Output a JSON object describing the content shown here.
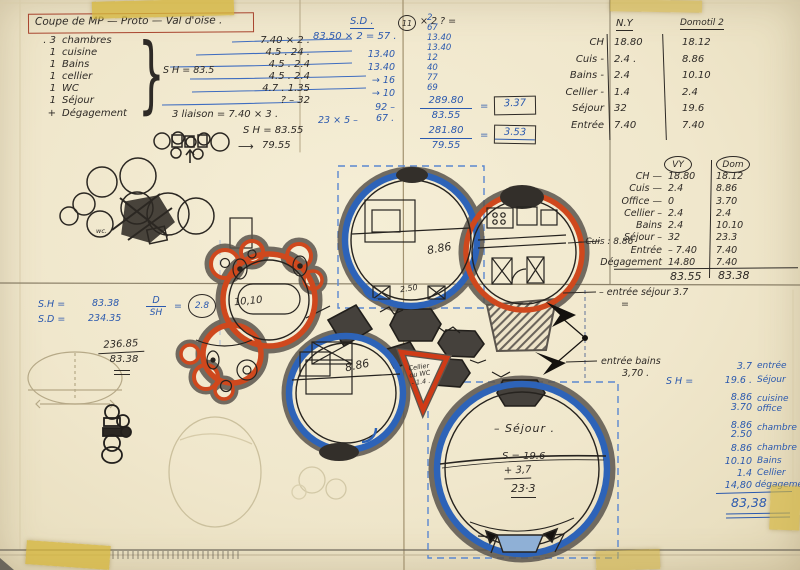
{
  "colors": {
    "paper": "#f0e8cf",
    "ink": "#2e2a26",
    "blue": "#2b59ae",
    "red": "#c63d17",
    "tape": "#d5b63e"
  },
  "icons": {
    "arrow_right": "⟶"
  },
  "title": "Coupe de MP — Proto — Val d'oise .",
  "program": {
    "items": [
      {
        "qty": ". 3",
        "label": "chambres"
      },
      {
        "qty": "1",
        "label": "cuisine"
      },
      {
        "qty": "1",
        "label": "Bains"
      },
      {
        "qty": "1",
        "label": "cellier"
      },
      {
        "qty": "1",
        "label": "WC"
      },
      {
        "qty": "1",
        "label": "Séjour"
      },
      {
        "qty": "+",
        "label": "Dégagement"
      }
    ],
    "sh_note": "S H = 83.5",
    "values": [
      "7.40 × 2 .",
      "4.5 . 24 .",
      "4.5 . 2.4",
      "4.5 . 2.4",
      "4.7 . 1.35",
      "? –   32",
      "3 liaison  =  7.40 × 3 ."
    ],
    "circle_value": "11",
    "circle_suffix": "× 2 ? =",
    "sh_total": "S H = 83.55",
    "arrow_total": "79.55",
    "wc_note": "wc."
  },
  "calc_sd": {
    "head": "S.D .",
    "line": "83.50 × 2  =  57 .",
    "vals": [
      "13.40",
      "13.40",
      "→ 16",
      "→ 10",
      "92 –"
    ],
    "last_left": "23 × 5 –",
    "last_right": "67 ."
  },
  "calc_right": {
    "col": [
      "2",
      "67",
      "13.40",
      "13.40",
      "12",
      "40",
      "77",
      "69"
    ],
    "f1_num": "289.80",
    "f1_den": "83.55",
    "eq": "=",
    "f1_res": "3.37",
    "f2_num": "281.80",
    "f2_den": "79.55",
    "f2_res": "3.53"
  },
  "table1": {
    "h1": "N.Y",
    "h2": "Domotil 2",
    "rows": [
      [
        "CH",
        "18.80",
        "18.12"
      ],
      [
        "Cuis -",
        "2.4 .",
        "8.86"
      ],
      [
        "Bains -",
        "2.4",
        "10.10"
      ],
      [
        "Cellier -",
        "1.4",
        "2.4"
      ],
      [
        "Séjour",
        "32",
        "19.6"
      ],
      [
        "Entrée",
        "7.40",
        "7.40"
      ]
    ]
  },
  "table2": {
    "h1": "VY",
    "h2": "Dom",
    "rows": [
      [
        "CH  —",
        "18.80",
        "18.12"
      ],
      [
        "Cuis  —",
        "2.4",
        "8.86"
      ],
      [
        "Office  —",
        "0",
        "3.70"
      ],
      [
        "Cellier  –",
        "2.4",
        "2.4"
      ],
      [
        "Bains",
        "2.4",
        "10.10"
      ],
      [
        "Séjour  –",
        "32",
        "23.3"
      ],
      [
        "Entrée",
        "– 7.40",
        "7.40"
      ],
      [
        "Dégagement",
        "14.80",
        "7.40"
      ]
    ],
    "note": "– Cuis : 8.86",
    "total1": "83.55",
    "total2": "83.38"
  },
  "annotations": {
    "a1": "– entrée séjour 3.7",
    "a1b": "=",
    "a2": "entrée bains",
    "a2b": "3,70 ."
  },
  "blue_list": {
    "sh_prefix": "S H =",
    "rows": [
      {
        "v": "3.7",
        "l": "entrée"
      },
      {
        "v": "19.6 .",
        "l": "Séjour"
      },
      {
        "v": "8.86",
        "l": "cuisine"
      },
      {
        "v": "3.70",
        "l": "office"
      },
      {
        "v": "8.86",
        "l": "chambre"
      },
      {
        "v": "2.50",
        "l": ""
      },
      {
        "v": "8.86",
        "l": "chambre"
      },
      {
        "v": "10.10",
        "l": "Bains"
      },
      {
        "v": "1.4",
        "l": "Cellier"
      },
      {
        "v": "14,80",
        "l": "dégagement"
      }
    ],
    "total": "83,38"
  },
  "calc_left": {
    "k1": "S.H  =",
    "v1": "83.38",
    "k2": "S.D  =",
    "v2": "234.35",
    "frac_num": "D",
    "frac_den": "SH",
    "eq": "=",
    "circle": "2.8",
    "black_num": "236.85",
    "black_den": "83.38"
  },
  "plan": {
    "room_top": "8.86",
    "room_top_w": "2.50",
    "bath": "10,10",
    "room_mid": "8.86",
    "cellier_1": "Cellier",
    "cellier_2": "ou WC",
    "cellier_3": "- 1.4 .",
    "sejour": "– Séjour .",
    "s_line1": "S =  19.6",
    "s_line2": "+    3,7",
    "s_line3": "23·3"
  }
}
